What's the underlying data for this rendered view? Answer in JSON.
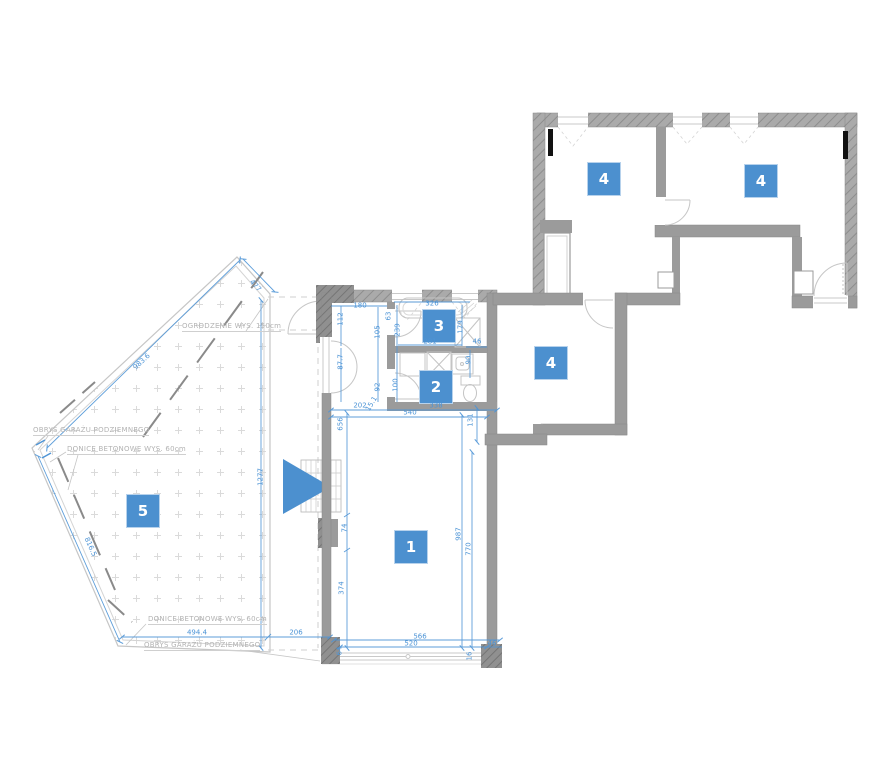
{
  "plan": {
    "colors": {
      "accent": "#4c90cf",
      "dimension": "#4d94d6",
      "wall": "#9b9b9b",
      "annotation": "#b3b3b3"
    },
    "rooms": [
      {
        "label": "1",
        "x": 394,
        "y": 530
      },
      {
        "label": "2",
        "x": 419,
        "y": 370
      },
      {
        "label": "3",
        "x": 422,
        "y": 309
      },
      {
        "label": "4",
        "x": 587,
        "y": 162
      },
      {
        "label": "4",
        "x": 744,
        "y": 164
      },
      {
        "label": "4",
        "x": 534,
        "y": 346
      },
      {
        "label": "5",
        "x": 126,
        "y": 494
      }
    ],
    "dimensions": [
      {
        "text": "180",
        "x": 360,
        "y": 306
      },
      {
        "text": "63",
        "x": 389,
        "y": 316,
        "rot": -90
      },
      {
        "text": "326",
        "x": 432,
        "y": 304
      },
      {
        "text": "112",
        "x": 341,
        "y": 319,
        "rot": -90
      },
      {
        "text": "105",
        "x": 378,
        "y": 332,
        "rot": -90
      },
      {
        "text": "239",
        "x": 398,
        "y": 330,
        "rot": -90
      },
      {
        "text": "179",
        "x": 461,
        "y": 327,
        "rot": -90
      },
      {
        "text": "281",
        "x": 430,
        "y": 342
      },
      {
        "text": "46",
        "x": 477,
        "y": 342
      },
      {
        "text": "90",
        "x": 469,
        "y": 360,
        "rot": -90
      },
      {
        "text": "87.7",
        "x": 341,
        "y": 362,
        "rot": -90
      },
      {
        "text": "92",
        "x": 378,
        "y": 387,
        "rot": -90
      },
      {
        "text": "100",
        "x": 396,
        "y": 385,
        "rot": -90
      },
      {
        "text": "202",
        "x": 360,
        "y": 406
      },
      {
        "text": "15.1",
        "x": 372,
        "y": 404,
        "rot": -60
      },
      {
        "text": "338",
        "x": 436,
        "y": 406
      },
      {
        "text": "540",
        "x": 410,
        "y": 413
      },
      {
        "text": "656",
        "x": 341,
        "y": 424,
        "rot": -90
      },
      {
        "text": "131",
        "x": 471,
        "y": 420,
        "rot": -90
      },
      {
        "text": "987",
        "x": 459,
        "y": 534,
        "rot": -90
      },
      {
        "text": "770",
        "x": 469,
        "y": 549,
        "rot": -90
      },
      {
        "text": "74",
        "x": 345,
        "y": 528,
        "rot": -90
      },
      {
        "text": "374",
        "x": 342,
        "y": 588,
        "rot": -90
      },
      {
        "text": "566",
        "x": 420,
        "y": 637
      },
      {
        "text": "520",
        "x": 411,
        "y": 644
      },
      {
        "text": "46",
        "x": 492,
        "y": 644
      },
      {
        "text": "16",
        "x": 470,
        "y": 656,
        "rot": -90
      },
      {
        "text": "64",
        "x": 340,
        "y": 651,
        "rot": -90
      },
      {
        "text": "494.4",
        "x": 197,
        "y": 633
      },
      {
        "text": "206",
        "x": 296,
        "y": 633
      },
      {
        "text": "1277",
        "x": 261,
        "y": 477,
        "rot": -90
      },
      {
        "text": "983.6",
        "x": 142,
        "y": 362,
        "rot": -43
      },
      {
        "text": "816.5",
        "x": 90,
        "y": 547,
        "rot": 66
      },
      {
        "text": "477",
        "x": 255,
        "y": 286,
        "rot": 48
      }
    ],
    "annotations": [
      {
        "text": "OGRODZENIE WYS. 150cm",
        "x": 182,
        "y": 322
      },
      {
        "text": "OBRYS GARAŻU PODZIEMNEGO",
        "x": 33,
        "y": 426
      },
      {
        "text": "DONICE BETONOWE WYS. 60cm",
        "x": 67,
        "y": 445
      },
      {
        "text": "DONICE BETONOWE WYS. 60cm",
        "x": 148,
        "y": 615
      },
      {
        "text": "OBRYS GARAŻU PODZIEMNEGO",
        "x": 144,
        "y": 641
      }
    ]
  }
}
